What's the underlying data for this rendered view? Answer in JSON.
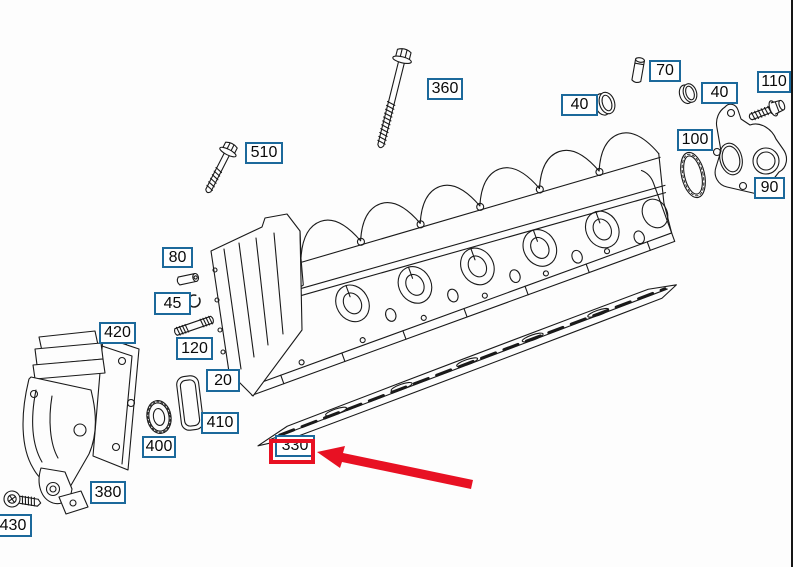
{
  "colors": {
    "label_border": "#1c699b",
    "label_text": "#0a0a0a",
    "line": "#1a1a1a",
    "highlight_red": "#e81123",
    "background": "#fdfdfd"
  },
  "diagram": {
    "part_labels": [
      {
        "id": "360",
        "text": "360",
        "x": 427,
        "y": 78,
        "w": 36,
        "h": 22
      },
      {
        "id": "510",
        "text": "510",
        "x": 245,
        "y": 142,
        "w": 38,
        "h": 22
      },
      {
        "id": "70",
        "text": "70",
        "x": 649,
        "y": 60,
        "w": 32,
        "h": 22
      },
      {
        "id": "40-left",
        "text": "40",
        "x": 561,
        "y": 94,
        "w": 37,
        "h": 22
      },
      {
        "id": "40-right",
        "text": "40",
        "x": 701,
        "y": 82,
        "w": 37,
        "h": 22
      },
      {
        "id": "110",
        "text": "110",
        "x": 757,
        "y": 71,
        "w": 34,
        "h": 22
      },
      {
        "id": "100",
        "text": "100",
        "x": 677,
        "y": 129,
        "w": 36,
        "h": 22
      },
      {
        "id": "90",
        "text": "90",
        "x": 754,
        "y": 177,
        "w": 31,
        "h": 22
      },
      {
        "id": "80",
        "text": "80",
        "x": 162,
        "y": 247,
        "w": 31,
        "h": 21
      },
      {
        "id": "45",
        "text": "45",
        "x": 154,
        "y": 292,
        "w": 37,
        "h": 23
      },
      {
        "id": "120",
        "text": "120",
        "x": 176,
        "y": 337,
        "w": 37,
        "h": 23
      },
      {
        "id": "420",
        "text": "420",
        "x": 99,
        "y": 322,
        "w": 37,
        "h": 22
      },
      {
        "id": "20",
        "text": "20",
        "x": 206,
        "y": 369,
        "w": 34,
        "h": 23
      },
      {
        "id": "410",
        "text": "410",
        "x": 201,
        "y": 412,
        "w": 38,
        "h": 22
      },
      {
        "id": "400",
        "text": "400",
        "x": 142,
        "y": 436,
        "w": 34,
        "h": 22
      },
      {
        "id": "380",
        "text": "380",
        "x": 90,
        "y": 481,
        "w": 36,
        "h": 23
      },
      {
        "id": "430",
        "text": "430",
        "x": -6,
        "y": 514,
        "w": 38,
        "h": 23
      },
      {
        "id": "330",
        "text": "330",
        "x": 275,
        "y": 435,
        "w": 40,
        "h": 22
      }
    ]
  },
  "highlight": {
    "target_label": "330",
    "box": {
      "x": 269,
      "y": 439,
      "w": 46,
      "h": 25,
      "border": 4
    },
    "arrow_points": "317,452 345,446 343,453 473,480 471,489 342,462 340,468"
  }
}
